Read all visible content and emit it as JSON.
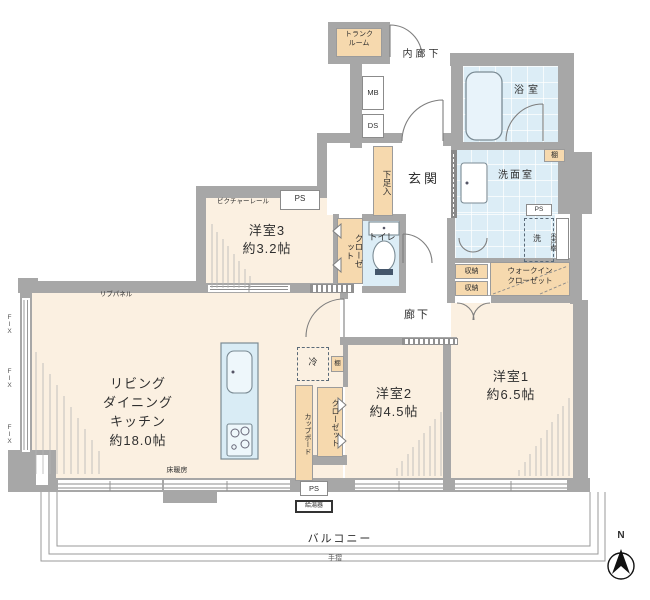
{
  "colors": {
    "wall": "#a7a7a7",
    "wall_dark": "#8a8a8a",
    "room_cream": "#fbf0e1",
    "storage_tan": "#f6d9ae",
    "water_blue": "#dcedf6",
    "kitchen_counter": "#d9ecf5",
    "outline": "#777777"
  },
  "labels": {
    "trunk_room": "トランク\nルーム",
    "inner_corridor": "内廊下",
    "mb": "MB",
    "ds": "DS",
    "bath": "浴室",
    "shelf_bath": "棚",
    "washroom": "洗面室",
    "ps_washroom": "PS",
    "laundry": "洗",
    "hanging_cupboard": "吊戸棚",
    "genkan": "玄関",
    "shoe_cabinet": "下足入",
    "toilet": "トイレ",
    "closet_room3": "クローゼット",
    "picture_rail": "ピクチャーレール",
    "ps_room3": "PS",
    "room3": "洋室3\n約3.2帖",
    "corridor": "廊下",
    "storage_1": "収納",
    "storage_2": "収納",
    "walk_in_closet": "ウォークイン\nクローゼット",
    "room1": "洋室1\n約6.5帖",
    "room2": "洋室2\n約4.5帖",
    "closet_room2": "クローゼット",
    "cupboard": "カップボード",
    "fridge": "冷",
    "shelf_kitchen": "棚",
    "ldk": "リビング\nダイニング\nキッチン\n約18.0帖",
    "rib_panel": "リブパネル",
    "floor_heating": "床暖房",
    "ps_bottom": "PS",
    "water_heater": "給湯器",
    "balcony": "バルコニー",
    "handrail": "手摺",
    "fix": "FIX"
  },
  "compass": {
    "label": "N"
  }
}
